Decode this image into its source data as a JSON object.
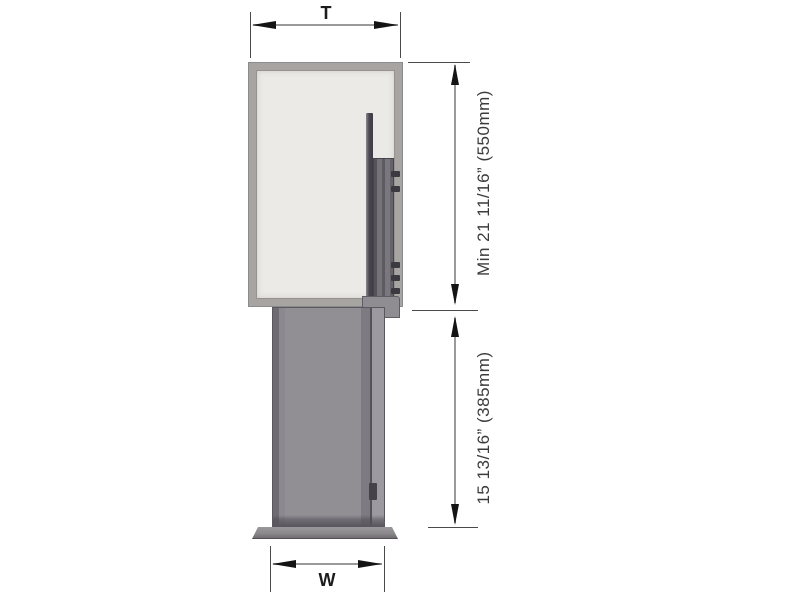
{
  "diagram": {
    "title": "pull-out unit dimension drawing",
    "labels": {
      "top_width": "T",
      "bottom_width": "W",
      "upper_min_height": "Min 21 11/16” (550mm)",
      "lower_height": "15 13/16” (385mm)"
    },
    "colors": {
      "background": "#ffffff",
      "cabinet_frame": "#a7a4a1",
      "cabinet_interior": "#eceae7",
      "rail_dark": "#4a4750",
      "pullout_body": "#918e94",
      "pullout_edge": "#6e6b72",
      "base_plate": "#8b898b",
      "dimension_line": "#9a9a9a",
      "extension_line": "#4a4a4a",
      "arrow": "#141414",
      "label_text": "#3b3b3b"
    }
  }
}
